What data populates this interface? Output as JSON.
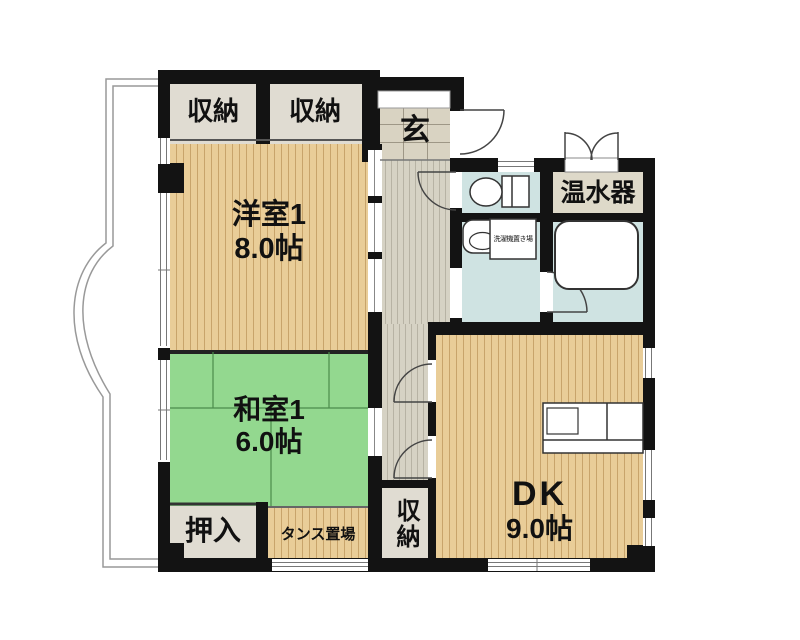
{
  "rooms": {
    "closet_top_left": {
      "label": "収納"
    },
    "closet_top_right": {
      "label": "収納"
    },
    "entrance": {
      "label": "玄"
    },
    "water_heater": {
      "label": "温水器"
    },
    "western_room": {
      "name": "洋室1",
      "size": "8.0帖"
    },
    "japanese_room": {
      "name": "和室1",
      "size": "6.0帖"
    },
    "oshiire_closet": {
      "label": "押入"
    },
    "tansu_space": {
      "label": "タンス置場"
    },
    "closet_bottom": {
      "label": "収納"
    },
    "dining_kitchen": {
      "name": "DK",
      "size": "9.0帖"
    },
    "laundry_space": {
      "label": "洗濯機置き場"
    }
  },
  "colors": {
    "wall": "#131313",
    "wood": "#e9cd98",
    "tatami": "#93d88f",
    "gray": "#e0dcd2",
    "heater": "#ded9c9",
    "water": "#cfe3e2",
    "hall": "#d6d2c4",
    "tile": "#d9d3c2"
  }
}
